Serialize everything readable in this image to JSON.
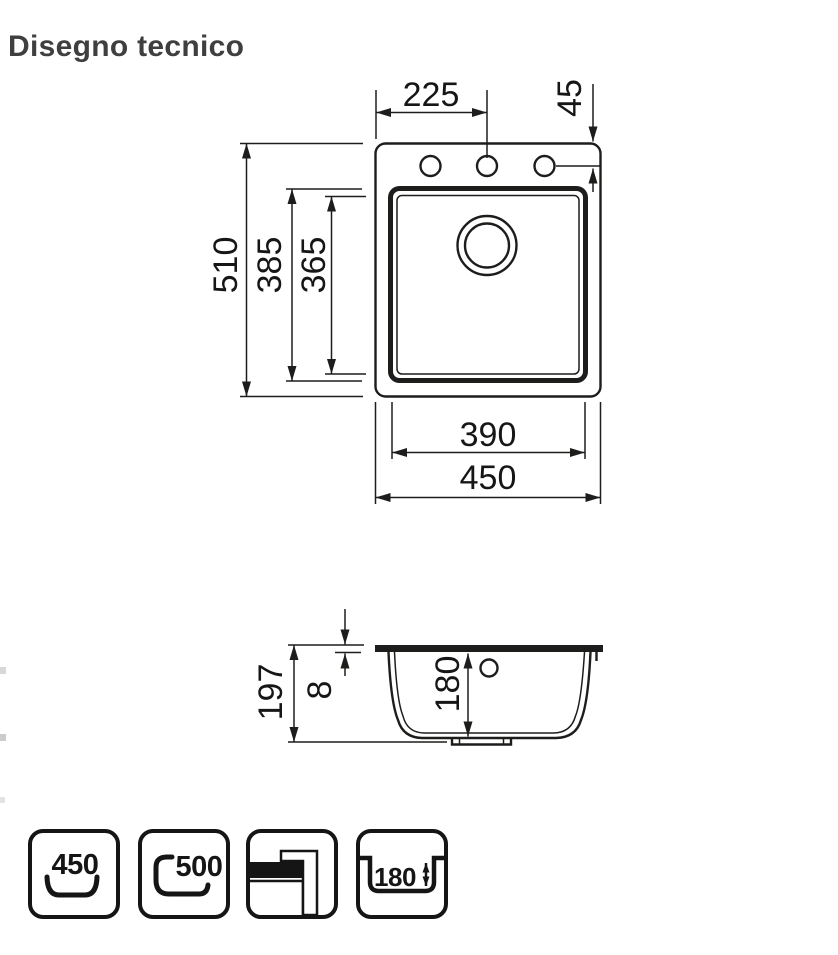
{
  "header": {
    "title": "Disegno tecnico"
  },
  "colors": {
    "ink": "#1d1d1b",
    "title": "#3f3f3f",
    "background": "#ffffff"
  },
  "drawing": {
    "labels": {
      "tap_hole_offset_x": "225",
      "tap_hole_offset_y": "45",
      "overall_depth": "510",
      "bowl_outer_depth": "385",
      "bowl_inner_depth": "365",
      "bowl_width": "390",
      "overall_width": "450",
      "section_total_height": "197",
      "section_rim_height": "8",
      "section_bowl_depth": "180"
    }
  },
  "footer_icons": [
    {
      "name": "min-base-unit-width-badge",
      "label": "450"
    },
    {
      "name": "min-base-unit-depth-badge",
      "label": "500"
    },
    {
      "name": "installation-type-badge",
      "label": ""
    },
    {
      "name": "bowl-depth-badge",
      "label": "180"
    }
  ]
}
